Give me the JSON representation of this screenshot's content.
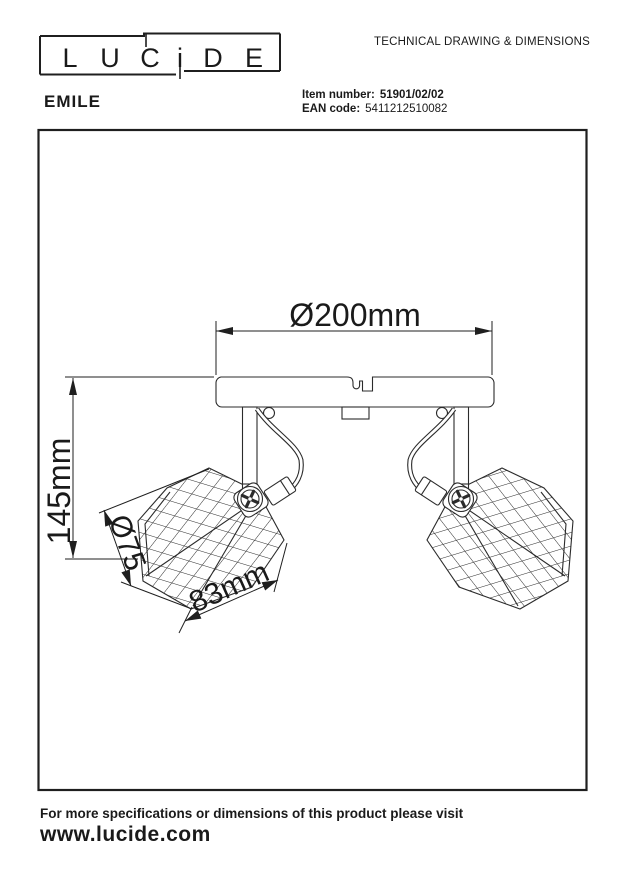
{
  "colors": {
    "ink": "#1a1a1a",
    "background": "#ffffff"
  },
  "header": {
    "doc_title": "TECHNICAL DRAWING & DIMENSIONS",
    "brand_letters": [
      "L",
      "U",
      "C",
      "i",
      "D",
      "E"
    ],
    "product_name": "EMILE",
    "item_number_label": "Item number:",
    "item_number_value": "51901/02/02",
    "ean_label": "EAN code:",
    "ean_value": "5411212510082"
  },
  "drawing": {
    "dim_width": "Ø200mm",
    "dim_height": "145mm",
    "dim_shade_diameter": "Ø75",
    "dim_shade_opening": "83mm"
  },
  "footer": {
    "note": "For more specifications or dimensions of this product please visit",
    "website": "www.lucide.com"
  }
}
